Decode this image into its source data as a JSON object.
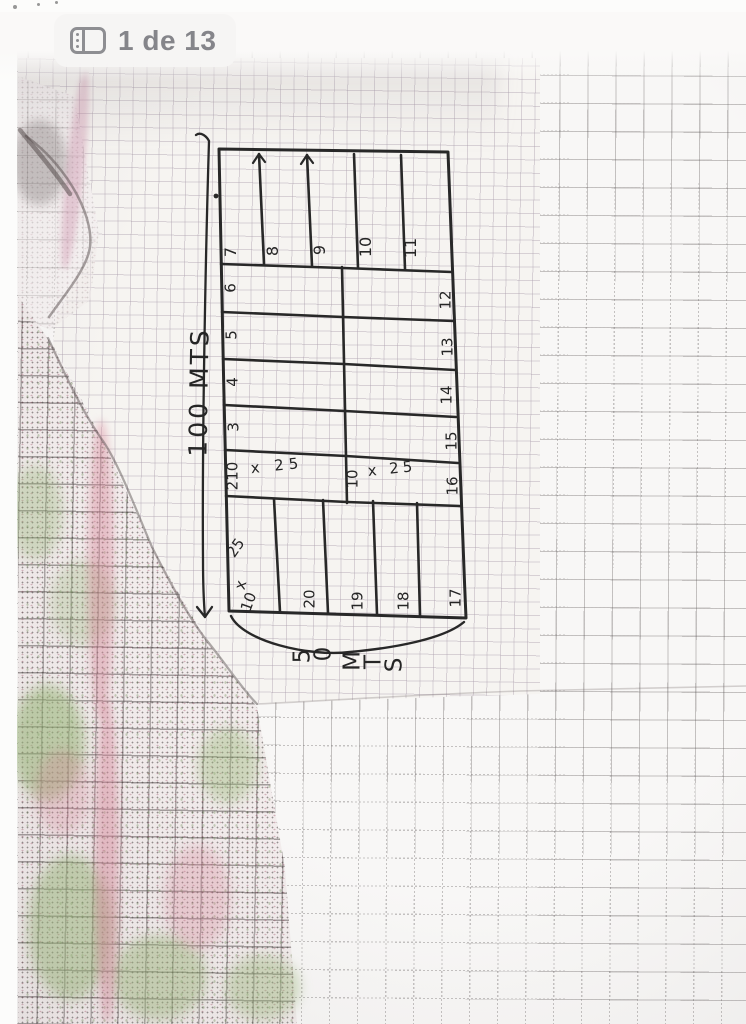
{
  "viewer": {
    "page_indicator": "1 de 13"
  },
  "sketch": {
    "dimension_left": "100 MTS",
    "dimension_bottom": [
      "5",
      "0",
      "M",
      "T",
      "S"
    ],
    "top_lots": [
      "7",
      "8",
      "9",
      "10",
      "11"
    ],
    "left_lots": [
      "6",
      "5",
      "4",
      "3"
    ],
    "right_lots": [
      "12",
      "13",
      "14",
      "15",
      "16"
    ],
    "bottom_lots": [
      "20",
      "19",
      "18",
      "17"
    ],
    "lot2_label": "210",
    "lot2_dim": "x 25",
    "middle_label": "10",
    "middle_dim": "x 25",
    "lot1_dim_parts": [
      "25",
      "x",
      "10"
    ]
  },
  "colors": {
    "ink": "#282828",
    "badge_text": "#85858a",
    "paper": "#f6f4f1",
    "pink_stain": "#d782a0",
    "green_stain": "#96b473"
  }
}
